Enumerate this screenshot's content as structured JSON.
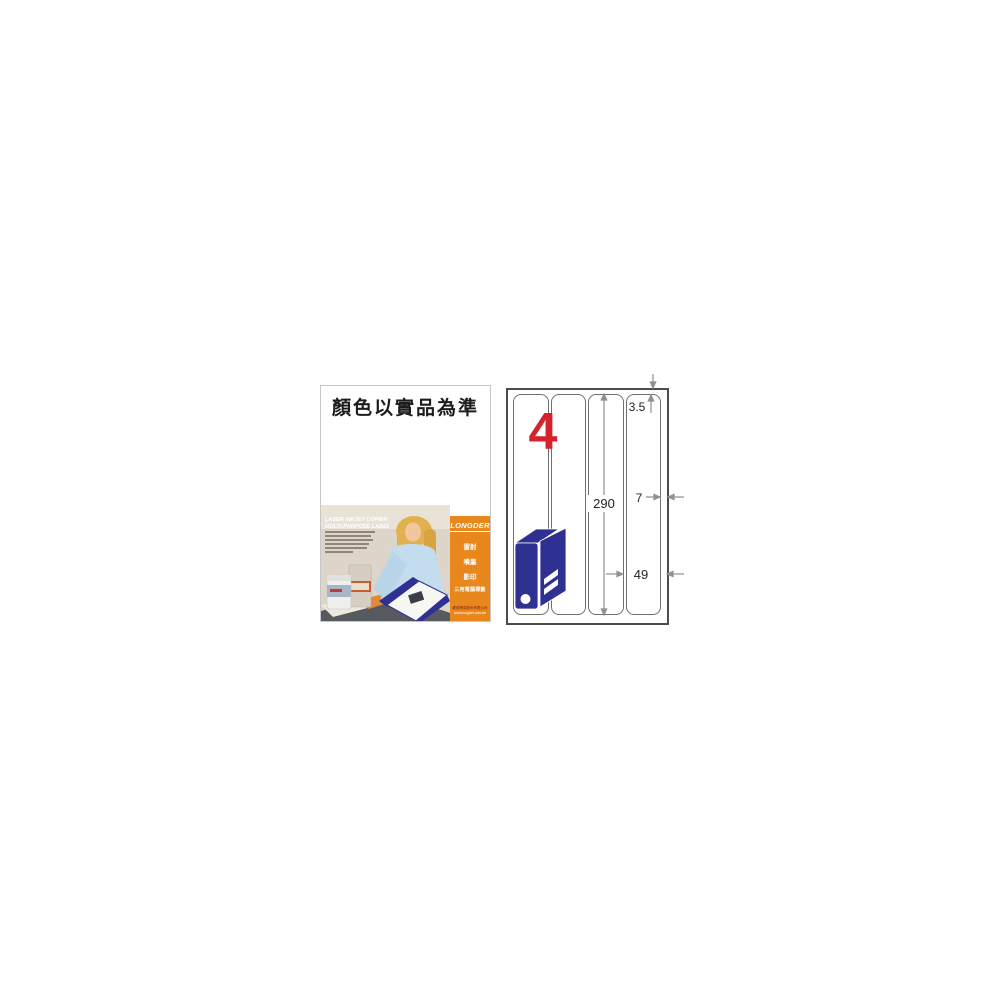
{
  "page": {
    "background": "#ffffff"
  },
  "left_panel": {
    "headline": "顏色以實品為準",
    "photo_slogan": {
      "line1": "LASER INKJET COPIER",
      "line2": "MULTI-PURPOSE LABEL"
    },
    "brand_band": {
      "logo_text": "LONGDER",
      "product_types": [
        "雷射",
        "噴墨",
        "影印",
        "三用電腦標籤"
      ],
      "footer_lines": [
        "龍德貿易股份有限公司",
        "www.longder.com.tw"
      ]
    }
  },
  "diagram": {
    "labels_per_sheet": "4",
    "column_count": 4,
    "dimensions": {
      "top_margin_mm": "3.5",
      "label_height_mm": "290",
      "side_margin_mm": "7",
      "label_width_mm": "49"
    },
    "colors": {
      "count_red": "#d4232b",
      "binder_blue": "#2e3192",
      "band_orange": "#e8881c",
      "arrow_gray": "#909090"
    }
  }
}
